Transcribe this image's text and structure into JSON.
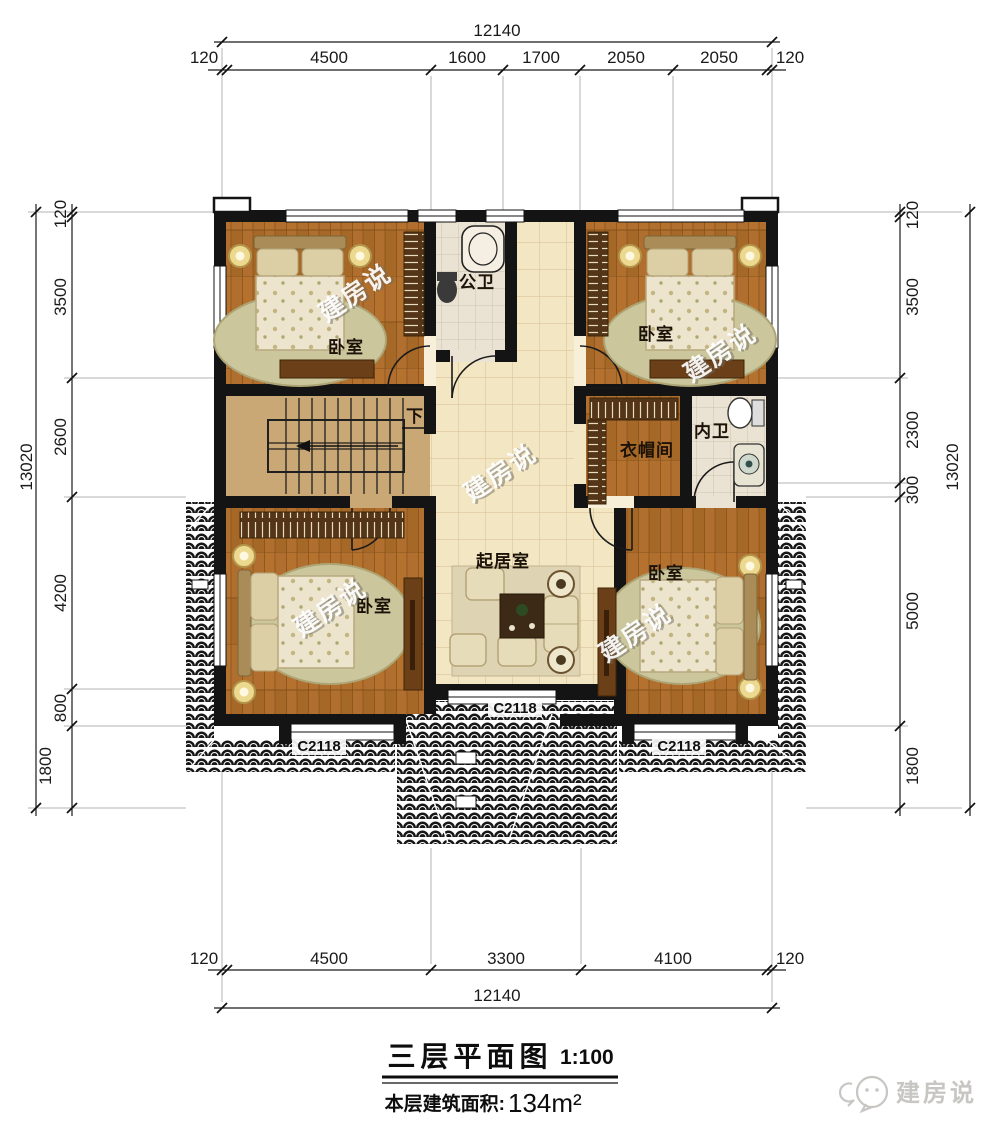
{
  "title": {
    "main": "三层平面图",
    "scale": "1:100",
    "area_label": "本层建筑面积:",
    "area_value": "134m²"
  },
  "watermark": "建房说",
  "logo": "建房说",
  "plan": {
    "rooms": {
      "bedroom_top_left": "卧室",
      "bedroom_top_right": "卧室",
      "bedroom_bottom_left": "卧室",
      "bedroom_bottom_right": "卧室",
      "public_bathroom": "公卫",
      "private_bathroom": "内卫",
      "cloakroom": "衣帽间",
      "living_room": "起居室",
      "stairs_down": "下"
    },
    "windows": {
      "left": "C2118",
      "center": "C2118",
      "right": "C2118"
    }
  },
  "dimensions": {
    "top": {
      "total": "12140",
      "segments": [
        "120",
        "4500",
        "1600",
        "1700",
        "2050",
        "2050",
        "120"
      ]
    },
    "bottom": {
      "total": "12140",
      "segments": [
        "120",
        "4500",
        "3300",
        "4100",
        "120"
      ]
    },
    "left": {
      "total": "13020",
      "segments": [
        "120",
        "3500",
        "2600",
        "4200",
        "800",
        "1800"
      ]
    },
    "right": {
      "total": "13020",
      "segments": [
        "120",
        "3500",
        "2300",
        "300",
        "5000",
        "1800"
      ]
    }
  },
  "colors": {
    "wall": "#141414",
    "wood": "#b06f2e",
    "hall_tile": "#f3e6c3",
    "bath_tile": "#eae2d2",
    "roof": "#171717",
    "accent_gold": "#ecd88f"
  }
}
